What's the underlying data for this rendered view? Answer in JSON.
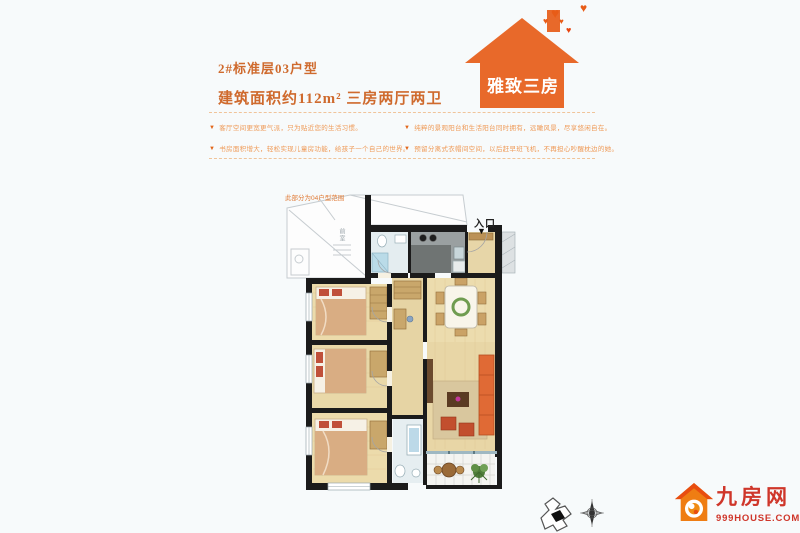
{
  "header": {
    "title": "2#标准层03户型",
    "subtitle": "建筑面积约112m² 三房两厅两卫"
  },
  "badge": {
    "label": "雅致三房",
    "heart": "♥",
    "color": "#e8692a"
  },
  "features": {
    "bullet": "▼",
    "left": [
      "客厅空间更宽更气派，只为贴近您的生活习惯。",
      "书房面积增大，轻松实现儿童房功能，给孩子一个自己的世界。"
    ],
    "right": [
      "纯粹的景观阳台和生活阳台同时拥有，远瞰风景，尽享悠闲自在。",
      "预留分离式衣帽间空间，以后赶早班飞机，不再担心吵醒枕边的她。"
    ]
  },
  "floor_plan": {
    "entrance_label": "入口",
    "entrance_arrow": "▼",
    "note": "此部分为04户型范围",
    "lobby_label": "前室"
  },
  "logo": {
    "name": "九房网",
    "domain": "999HOUSE.COM",
    "color": "#cf362a"
  },
  "colors": {
    "title": "#cf6a2d",
    "bullet_text": "#ef9a57",
    "wall": "#1b1b1b"
  }
}
